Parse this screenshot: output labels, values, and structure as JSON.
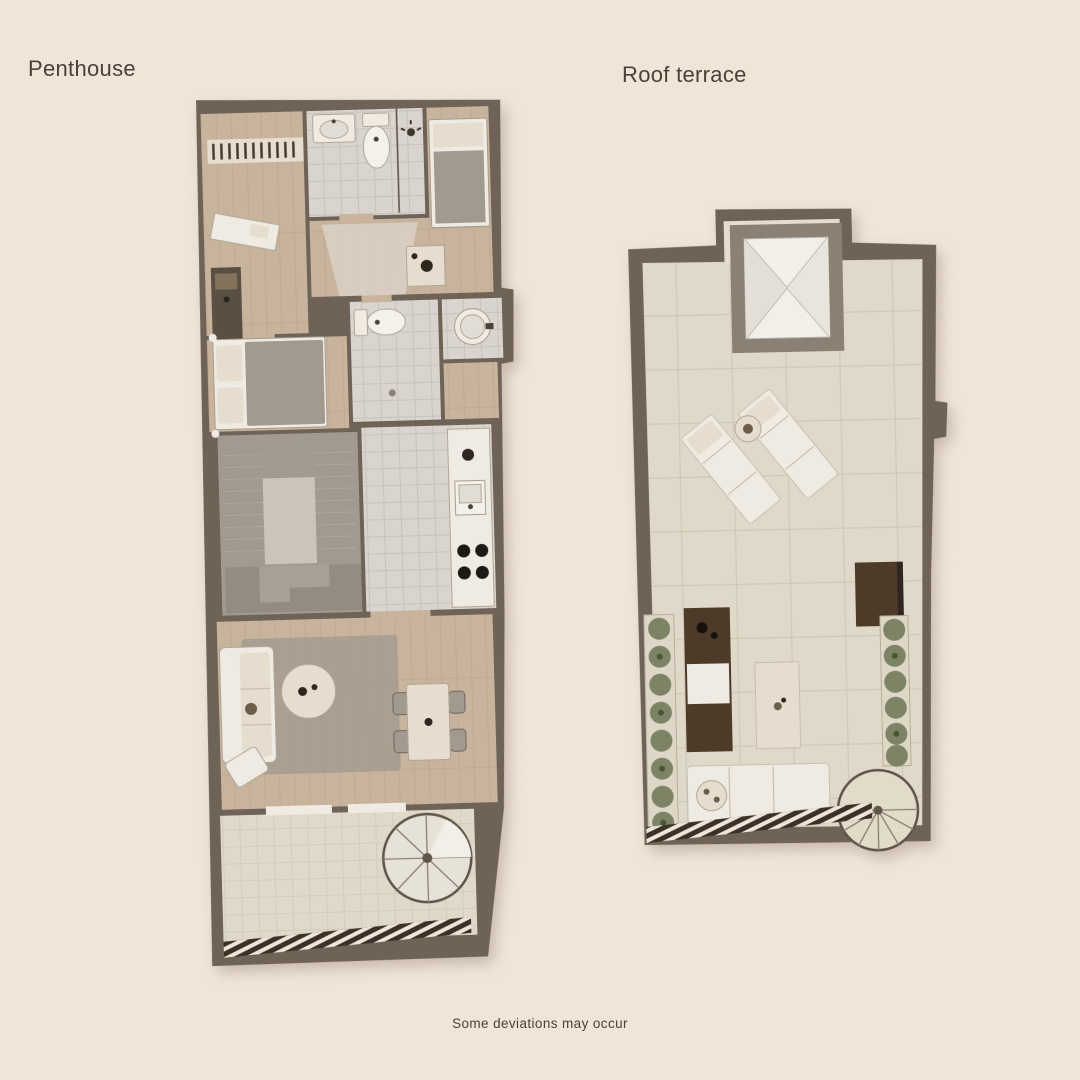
{
  "page": {
    "title_left": "Penthouse",
    "title_right": "Roof terrace",
    "disclaimer": "Some deviations may occur"
  },
  "colors": {
    "bg": "#f0e5d9",
    "wall": "#6e6356",
    "wallLight": "#8c8173",
    "wood": "#c8b39d",
    "tile": "#d9d5ce",
    "terr": "#e0d8c8",
    "gray": "#a29a8f",
    "grayLight": "#cbc4ba",
    "white": "#efebe3",
    "cream": "#e6ddcf",
    "rug": "#a69c90",
    "brown": "#4e3a29",
    "brownDeep": "#2f2620",
    "plant": "#7c8465",
    "rail": "#3b3128",
    "text": "#4a4138"
  },
  "plans": [
    {
      "name": "Penthouse",
      "features": [
        "wardrobe",
        "bathroom-with-sink-toilet-shower",
        "single-bedroom",
        "desk",
        "master-bedroom-double-bed",
        "second-bathroom-toilet-shower",
        "round-basin",
        "staircase",
        "kitchen-with-sink-and-stove",
        "living-room-sofa-rug-coffee-table",
        "dining-table-four-chairs",
        "terrace",
        "spiral-staircase",
        "railing"
      ]
    },
    {
      "name": "Roof terrace",
      "features": [
        "skylight-pyramid",
        "two-sun-loungers",
        "side-table",
        "fire-table",
        "planters-with-plants",
        "outdoor-kitchen-counter",
        "outdoor-table",
        "outdoor-sofa",
        "railing",
        "spiral-staircase-top"
      ]
    }
  ]
}
